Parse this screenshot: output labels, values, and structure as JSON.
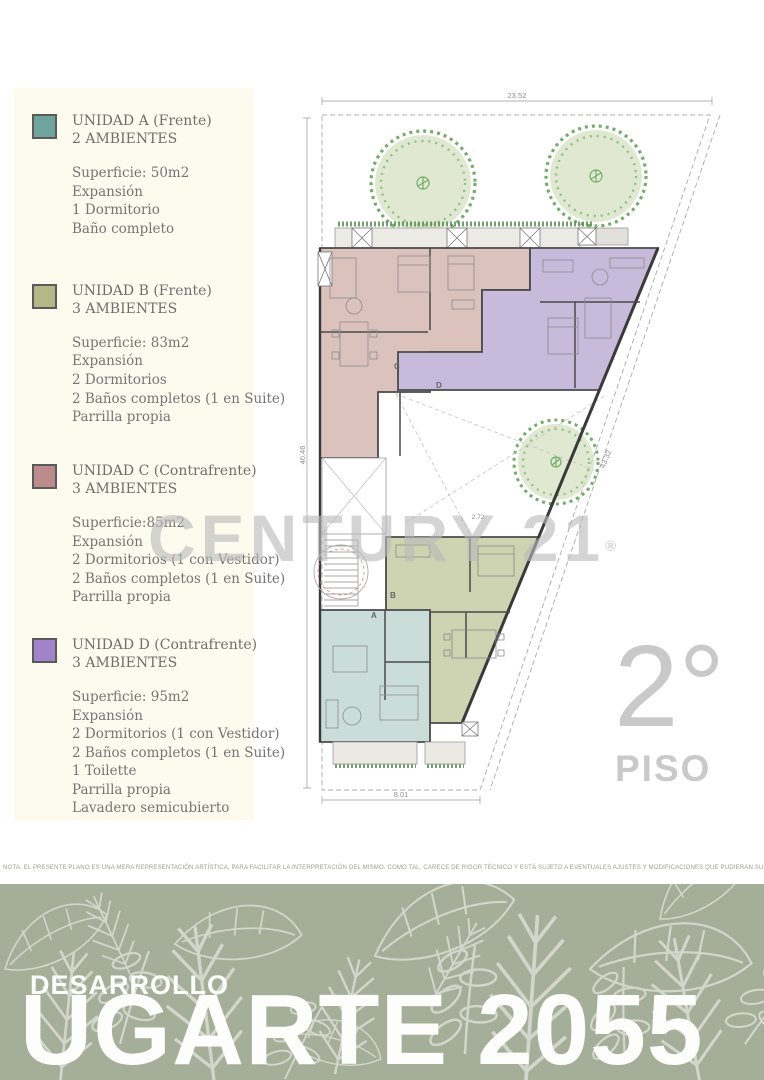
{
  "legend": {
    "units": [
      {
        "letter": "A",
        "title": "UNIDAD A (Frente)",
        "subtitle": "2 AMBIENTES",
        "details": [
          "Superficie: 50m2",
          "Expansión",
          "1 Dormitorio",
          "Baño completo"
        ]
      },
      {
        "letter": "B",
        "title": "UNIDAD B (Frente)",
        "subtitle": "3 AMBIENTES",
        "details": [
          "Superficie: 83m2",
          "Expansión",
          "2 Dormitorios",
          "2 Baños completos (1 en Suite)",
          "Parrilla propia"
        ]
      },
      {
        "letter": "C",
        "title": "UNIDAD C (Contrafrente)",
        "subtitle": "3 AMBIENTES",
        "details": [
          "Superficie:85m2",
          "Expansión",
          "2 Dormitorios (1 con Vestidor)",
          "2 Baños completos (1 en Suite)",
          "Parrilla propia"
        ]
      },
      {
        "letter": "D",
        "title": "UNIDAD D (Contrafrente)",
        "subtitle": "3 AMBIENTES",
        "details": [
          "Superficie: 95m2",
          "Expansión",
          "2 Dormitorios (1 con Vestidor)",
          "2 Baños completos (1 en Suite)",
          "1 Toilette",
          "Parrilla propia",
          "Lavadero semicubierto"
        ]
      }
    ]
  },
  "plan": {
    "dimensions": {
      "top": "23.52",
      "left": "40.46",
      "right": "43.32",
      "bottom": "8.01",
      "inner": "2.72"
    },
    "unit_labels": {
      "a": "A",
      "b": "B",
      "c": "C",
      "d": "D"
    },
    "watermark_text": "CENTURY 21",
    "watermark_reg": "®",
    "floor_number": "2°",
    "floor_word": "PISO"
  },
  "footer": {
    "note": "NOTA: EL PRESENTE PLANO ES UNA MERA REPRESENTACIÓN ARTÍSTICA, PARA FACILITAR LA INTERPRETACIÓN DEL MISMO. COMO TAL, CARECE DE RIGOR TÉCNICO Y ESTÁ SUJETO A EVENTUALES AJUSTES Y MODIFICACIONES QUE PUDIERAN SURGIR DEL MISMO.",
    "brand_small": "DESARROLLO",
    "brand_large": "UGARTE 2055"
  },
  "colors": {
    "legend_a": "#6FA39E",
    "legend_b": "#B3B886",
    "legend_c": "#BC8B8B",
    "legend_d": "#A083C9",
    "plan_a": "#CBDDD9",
    "plan_b": "#CED3B1",
    "plan_c": "#DCC2BD",
    "plan_d": "#C7BADB",
    "band": "#A5AE98",
    "watermark": "rgba(185,185,185,0.62)",
    "floor_label": "#C9C9C9"
  }
}
